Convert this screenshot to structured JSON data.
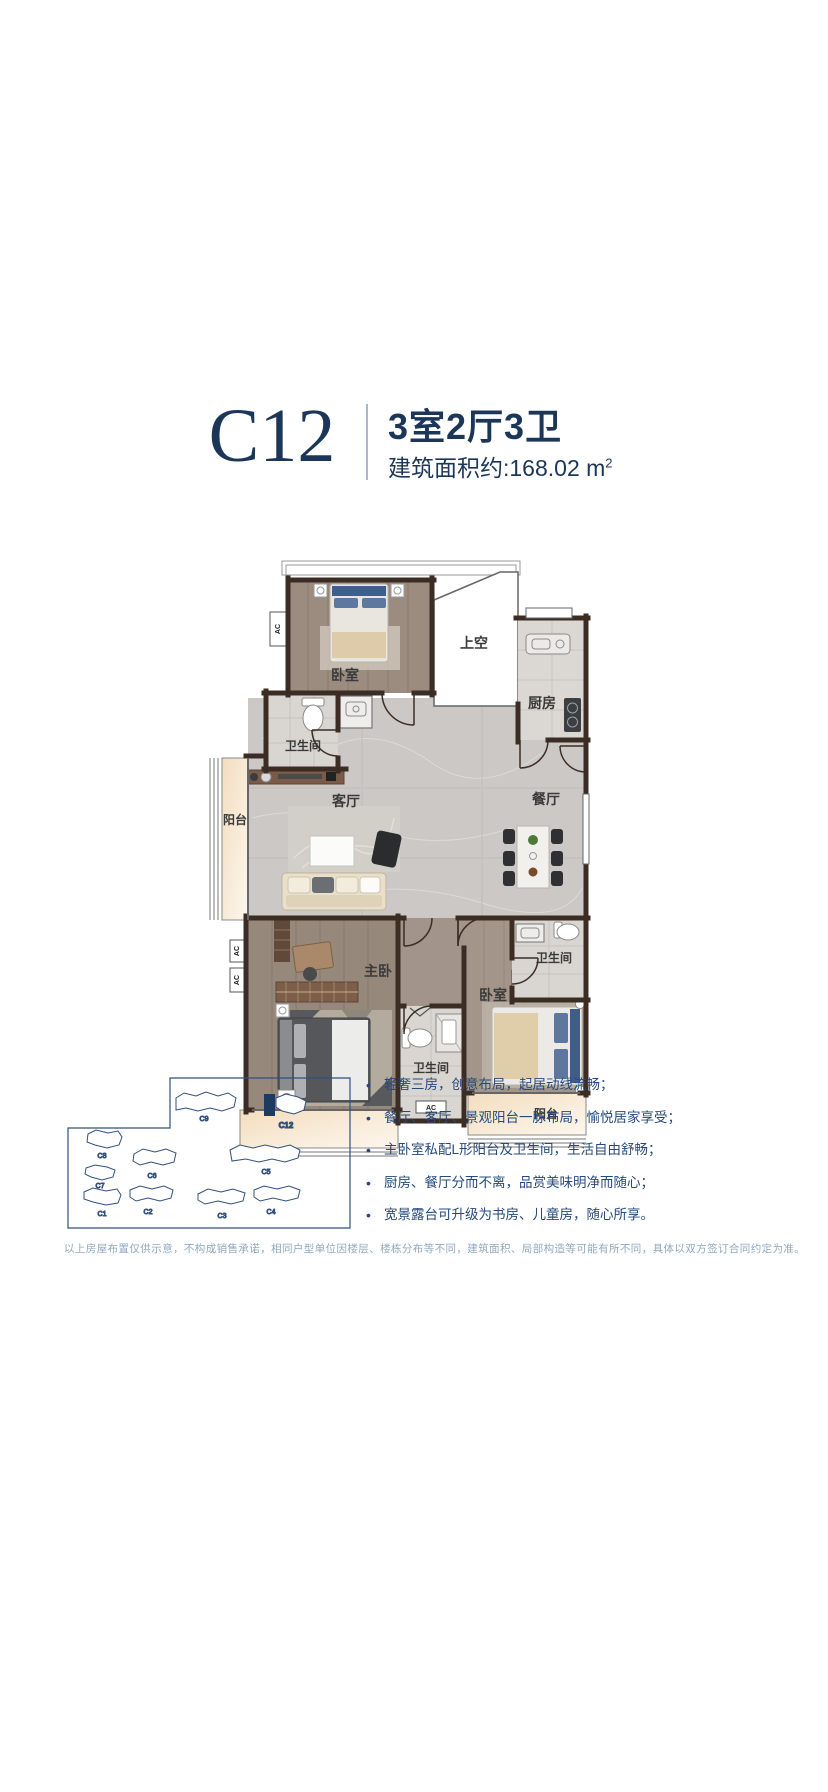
{
  "header": {
    "unit_code": "C12",
    "title": "3室2厅3卫",
    "area_label": "建筑面积约:168.02 m",
    "area_sup": "2"
  },
  "floor_plan": {
    "labels": {
      "bedroom_top": "卧室",
      "void": "上空",
      "kitchen": "厨房",
      "bath_top": "卫生间",
      "living_room": "客厅",
      "dining_room": "餐厅",
      "balcony_left": "阳台",
      "master_bedroom": "主卧",
      "bath_right": "卫生间",
      "bedroom_bottom": "卧室",
      "bath_bottom": "卫生间",
      "balcony_bottom": "阳台",
      "ac": "AC"
    }
  },
  "site_plan": {
    "buildings": [
      {
        "id": "C9",
        "highlighted": false
      },
      {
        "id": "C12",
        "highlighted": true
      },
      {
        "id": "C8",
        "highlighted": false
      },
      {
        "id": "C6",
        "highlighted": false
      },
      {
        "id": "C5",
        "highlighted": false
      },
      {
        "id": "C7",
        "highlighted": false
      },
      {
        "id": "C1",
        "highlighted": false
      },
      {
        "id": "C2",
        "highlighted": false
      },
      {
        "id": "C3",
        "highlighted": false
      },
      {
        "id": "C4",
        "highlighted": false
      }
    ]
  },
  "features": {
    "items": [
      "轻奢三房，创意布局，起居动线流畅；",
      "餐厅、客厅、景观阳台一脉布局，愉悦居家享受；",
      "主卧室私配L形阳台及卫生间，生活自由舒畅；",
      "厨房、餐厅分而不离，品赏美味明净而随心；",
      "宽景露台可升级为书房、儿童房，随心所享。"
    ]
  },
  "disclaimer": "以上房屋布置仅供示意，不构成销售承诺，相同户型单位因楼层、楼栋分布等不同，建筑面积、局部构造等可能有所不同，具体以双方签订合同约定为准。",
  "colors": {
    "navy": "#1c3657",
    "wall": "#3b2d23",
    "balcony": "#f6e5cf"
  }
}
